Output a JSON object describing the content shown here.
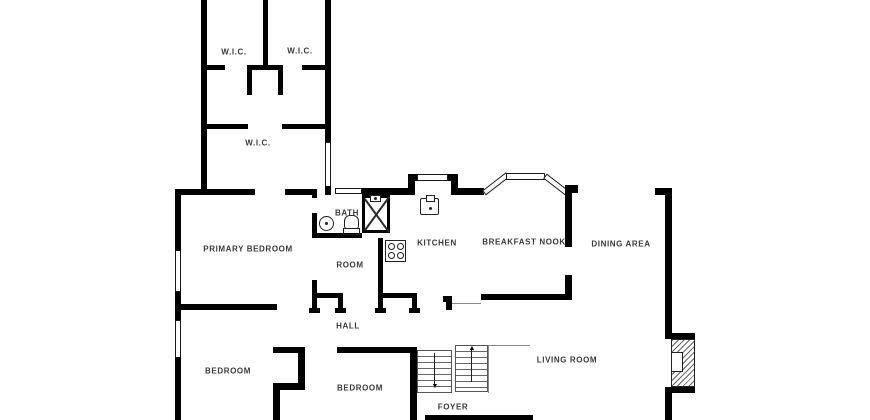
{
  "floorplan": {
    "title": "single-storey floor plan",
    "colors": {
      "wall": "#000000",
      "background": "#ffffff",
      "label": "#3a3a3a",
      "thin_line": "#8a8a8a"
    },
    "rooms": [
      {
        "id": "wic-upper-left",
        "label": "W.I.C.",
        "x": 234,
        "y": 52
      },
      {
        "id": "wic-upper-right",
        "label": "W.I.C.",
        "x": 300,
        "y": 51
      },
      {
        "id": "wic-lower",
        "label": "W.I.C.",
        "x": 258,
        "y": 143
      },
      {
        "id": "primary-bedroom",
        "label": "PRIMARY BEDROOM",
        "x": 248,
        "y": 249
      },
      {
        "id": "bath",
        "label": "BATH",
        "x": 347,
        "y": 213
      },
      {
        "id": "room",
        "label": "ROOM",
        "x": 350,
        "y": 265
      },
      {
        "id": "kitchen",
        "label": "KITCHEN",
        "x": 437,
        "y": 243
      },
      {
        "id": "breakfast-nook",
        "label": "BREAKFAST NOOK",
        "x": 524,
        "y": 242
      },
      {
        "id": "dining-area",
        "label": "DINING AREA",
        "x": 621,
        "y": 244
      },
      {
        "id": "hall",
        "label": "HALL",
        "x": 348,
        "y": 326
      },
      {
        "id": "bedroom-left",
        "label": "BEDROOM",
        "x": 228,
        "y": 371
      },
      {
        "id": "bedroom-middle",
        "label": "BEDROOM",
        "x": 360,
        "y": 388
      },
      {
        "id": "living-room",
        "label": "LIVING ROOM",
        "x": 567,
        "y": 360
      },
      {
        "id": "foyer",
        "label": "FOYER",
        "x": 453,
        "y": 407
      }
    ],
    "stairs": {
      "up_arrow": "▲",
      "down_arrow": "▼"
    },
    "fixtures": [
      {
        "name": "shower"
      },
      {
        "name": "bathroom-sink"
      },
      {
        "name": "toilet"
      },
      {
        "name": "kitchen-sink"
      },
      {
        "name": "stove"
      },
      {
        "name": "fireplace"
      },
      {
        "name": "staircase"
      },
      {
        "name": "bay-window"
      }
    ]
  }
}
